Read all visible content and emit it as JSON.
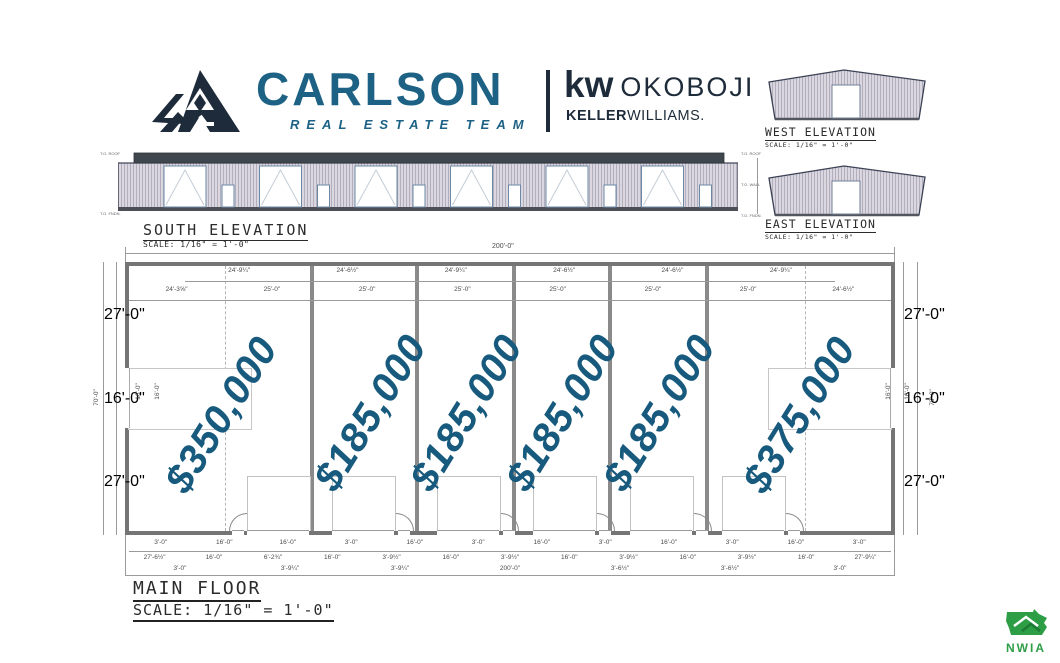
{
  "brand": {
    "name": "CARLSON",
    "tagline": "REAL ESTATE TEAM",
    "kw_mark": "kw",
    "kw_market": "OKOBOJI",
    "kw_sub_bold": "KELLER",
    "kw_sub_rest": "WILLIAMS.",
    "accent_teal": "#1d6285",
    "accent_navy": "#1e2b3a"
  },
  "elevations": {
    "west": {
      "title": "WEST ELEVATION",
      "scale": "SCALE: 1/16\" = 1'-0\""
    },
    "east": {
      "title": "EAST ELEVATION",
      "scale": "SCALE: 1/16\" = 1'-0\""
    },
    "south": {
      "title": "SOUTH ELEVATION",
      "scale": "SCALE: 1/16\" = 1'-0\"",
      "markers_left": [
        "T.O. ROOF",
        "T.O. FNDN."
      ],
      "markers_right": [
        "T.O. ROOF",
        "T.O. WALL",
        "T.O. FNDN."
      ]
    }
  },
  "floor_plan": {
    "title": "MAIN FLOOR",
    "scale": "SCALE: 1/16\" = 1'-0\"",
    "overall_width_top": "200'-0\"",
    "price_color": "#175a7e",
    "prices": [
      "$350,000",
      "$185,000",
      "$185,000",
      "$185,000",
      "$185,000",
      "$375,000"
    ],
    "dims": {
      "top_row1": [
        "24'-9¼\"",
        "24'-6½\"",
        "24'-9¼\"",
        "24'-6½\"",
        "24'-6½\"",
        "24'-9¼\""
      ],
      "top_row2": [
        "24'-3⅝\"",
        "25'-0\"",
        "25'-0\"",
        "25'-0\"",
        "25'-0\"",
        "25'-0\"",
        "25'-0\"",
        "24'-6½\""
      ],
      "bottom_row1": [
        "3'-0\"",
        "16'-0\"",
        "16'-0\"",
        "3'-0\"",
        "16'-0\"",
        "3'-0\"",
        "16'-0\"",
        "3'-0\"",
        "16'-0\"",
        "3'-0\"",
        "16'-0\"",
        "3'-0\""
      ],
      "bottom_row2": [
        "27'-6½\"",
        "16'-0\"",
        "6'-2¾\"",
        "16'-0\"",
        "3'-9½\"",
        "16'-0\"",
        "3'-9½\"",
        "16'-0\"",
        "3'-9½\"",
        "16'-0\"",
        "3'-9½\"",
        "16'-0\"",
        "27'-9¼\""
      ],
      "bottom_row3": [
        "3'-0\"",
        "3'-9¼\"",
        "3'-9¼\"",
        "200'-0\"",
        "3'-6½\"",
        "3'-6½\"",
        "3'-0\""
      ],
      "left_outer": "70'-0\"",
      "left_segments": [
        "27'-0\"",
        "16'-0\"",
        "27'-0\""
      ],
      "left_inner": [
        "16'-0\"",
        "16'-0\""
      ],
      "right_segments": [
        "27'-0\"",
        "16'-0\"",
        "27'-0\""
      ],
      "right_inner": [
        "16'-0\"",
        "16'-0\""
      ],
      "right_outer": "70'-0\""
    }
  },
  "footer_logo": {
    "text": "NWIA"
  }
}
